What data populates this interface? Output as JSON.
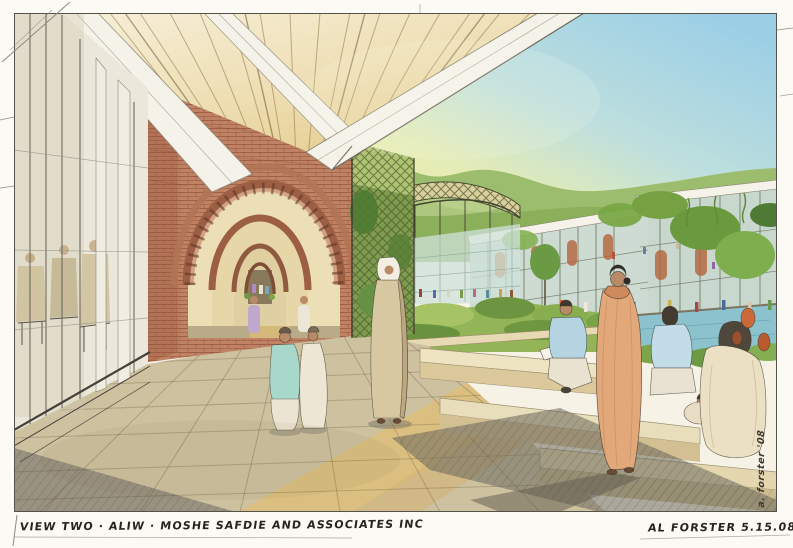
{
  "artwork": {
    "type": "hand-drawn architectural watercolor perspective rendering",
    "caption": "VIEW TWO · ALIW · MOSHE SAFDIE AND ASSOCIATES INC",
    "credit": "AL FORSTER 5.15.08",
    "side_signature": "a. forster '08"
  },
  "palette": {
    "paper": "#fbfaf5",
    "pencil": "#55524a",
    "sky_blue": "#9ccfe6",
    "sky_yellow": "#f4ec9e",
    "hill_green": "#9dbd6e",
    "foliage_dark": "#4e7a33",
    "foliage_light": "#a6c465",
    "ceiling_wood": "#e4cc8e",
    "beam_white": "#f4f2e9",
    "brick": "#c08264",
    "brick_dark": "#9c5f44",
    "floor_sun": "#dcbf7c",
    "floor_tan": "#cdc1a0",
    "floor_shadow": "#8f8a7a",
    "planter_tan": "#e6d9b4",
    "pond_blue": "#8cc2ce",
    "glass_green": "#cfe2da",
    "skin": "#b98a66",
    "sari_peach": "#e2a87a",
    "teal_garment": "#a8d8cc",
    "shirt_blue": "#b5d4e2",
    "ink": "#26241f"
  },
  "scene": {
    "description": "Covered brick arcade walkway at left opening onto a landscaped courtyard with a curved trellis pavilion, terraced gardens, a pond and multi-storey galleried buildings set against green hills; figures walk the arcade and sit on the terrace steps.",
    "elements": [
      "wood-slat canopy ceiling",
      "white canopy beams",
      "brick arches",
      "glass curtain wall with seated people",
      "paved walkway",
      "trellis pavilion",
      "courtyard gardens",
      "pond",
      "galleried buildings",
      "green hills",
      "sky",
      "walking figures",
      "seated figures",
      "terraced planters"
    ]
  }
}
